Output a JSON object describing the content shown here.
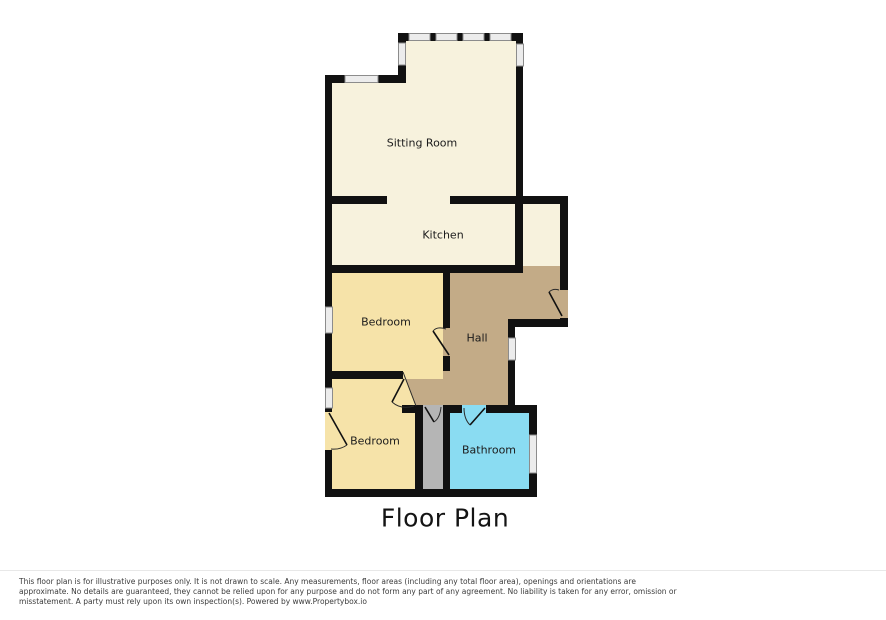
{
  "title": "Floor Plan",
  "rooms": [
    {
      "name": "sitting-room",
      "label": "Sitting Room",
      "color": "#f7f2dd"
    },
    {
      "name": "kitchen",
      "label": "Kitchen",
      "color": "#f7f2dd"
    },
    {
      "name": "bedroom-1",
      "label": "Bedroom",
      "color": "#f6e3a9"
    },
    {
      "name": "hall",
      "label": "Hall",
      "color": "#c3ab87"
    },
    {
      "name": "bedroom-2",
      "label": "Bedroom",
      "color": "#f6e3a9"
    },
    {
      "name": "bathroom",
      "label": "Bathroom",
      "color": "#8adcf2"
    }
  ],
  "colors": {
    "wall": "#111111",
    "storage": "#b5b5b5",
    "window": "#ececec",
    "background": "#ffffff"
  },
  "disclaimer": {
    "line1": "This floor plan is for illustrative purposes only. It is not drawn to scale. Any measurements, floor areas (including any total floor area), openings and orientations are",
    "line2": "approximate. No details are guaranteed, they cannot be relied upon for any purpose and do not form any part of any agreement. No liability is taken for any error, omission or",
    "line3": "misstatement. A party must rely upon its own inspection(s). Powered by www.Propertybox.io"
  }
}
